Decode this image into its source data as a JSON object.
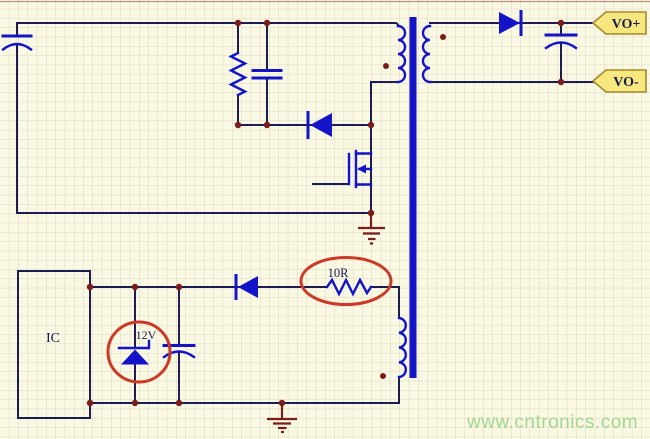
{
  "labels": {
    "ic": "IC",
    "zener": "12V",
    "resistor": "10R",
    "vo_plus": "VO+",
    "vo_minus": "VO-"
  },
  "watermark": "www.cntronics.com",
  "colors": {
    "bg": "#f9f8e2",
    "grid": "#d8cdb9",
    "wire": "#1c1c52",
    "component": "#1313c8",
    "junction": "#7a1c1c",
    "ground": "#7a1c1c",
    "annotation": "#cb3a27",
    "tag_fill": "#f6e87f",
    "tag_border": "#a38a2e",
    "label": "#1a1a52",
    "watermark": "#8ed080",
    "sheet_border": "#8a3c3c"
  }
}
